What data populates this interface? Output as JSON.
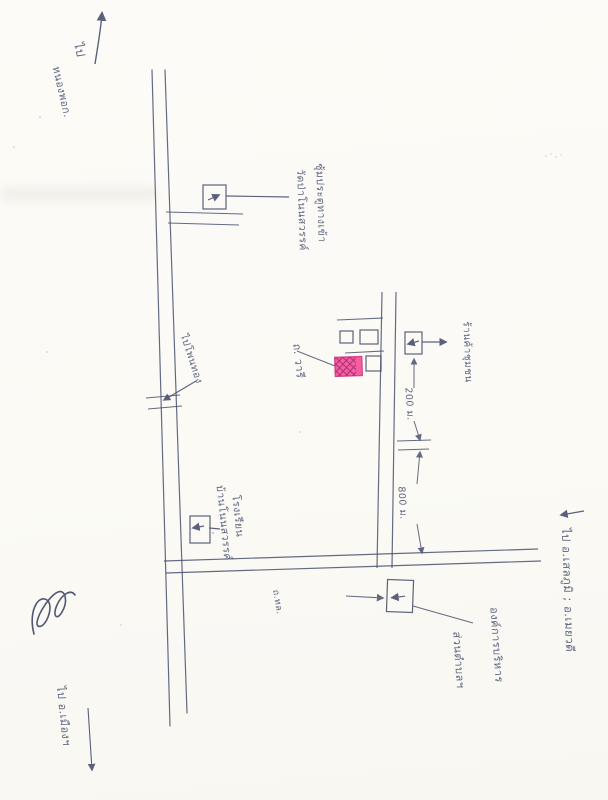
{
  "document": {
    "type": "hand-drawn location sketch map (scanned)",
    "colors": {
      "paper": "#fcfbf7",
      "ink": "#4a5170",
      "highlight_fill": "#f55fa2",
      "highlight_hatch": "#ad2f73",
      "highlight_border": "#d6478e"
    }
  },
  "map": {
    "directions": {
      "north": {
        "line1": "ไป",
        "line2": "หนองพอก."
      },
      "west": {
        "label": "ไปโพนทอง"
      },
      "south": {
        "label": "ไป อ.เมืองฯ"
      },
      "east": {
        "label": "ไป อ.เสลภูมิ ; อ.เมยวดี"
      }
    },
    "roads": {
      "target_road_name": "ถ. วารี",
      "small_road_label": "ถ.ทล."
    },
    "landmarks": {
      "gate": {
        "line1": "ซุ้มประตูทางเข้า",
        "line2": "วัดป่าโนนสวรรค์"
      },
      "shop": {
        "label": "ร้านค้าชุมชน"
      },
      "school": {
        "line1": "โรงเรียน",
        "line2": "บ้านโนนสวรรค์"
      },
      "sao": {
        "line1": "องค์การบริหาร",
        "line2": "ส่วนตำบลฯ"
      }
    },
    "distances": {
      "d1": "200 ม.",
      "d2": "800 ม."
    },
    "target_marker": "pink cross-hatched building (destination)"
  }
}
